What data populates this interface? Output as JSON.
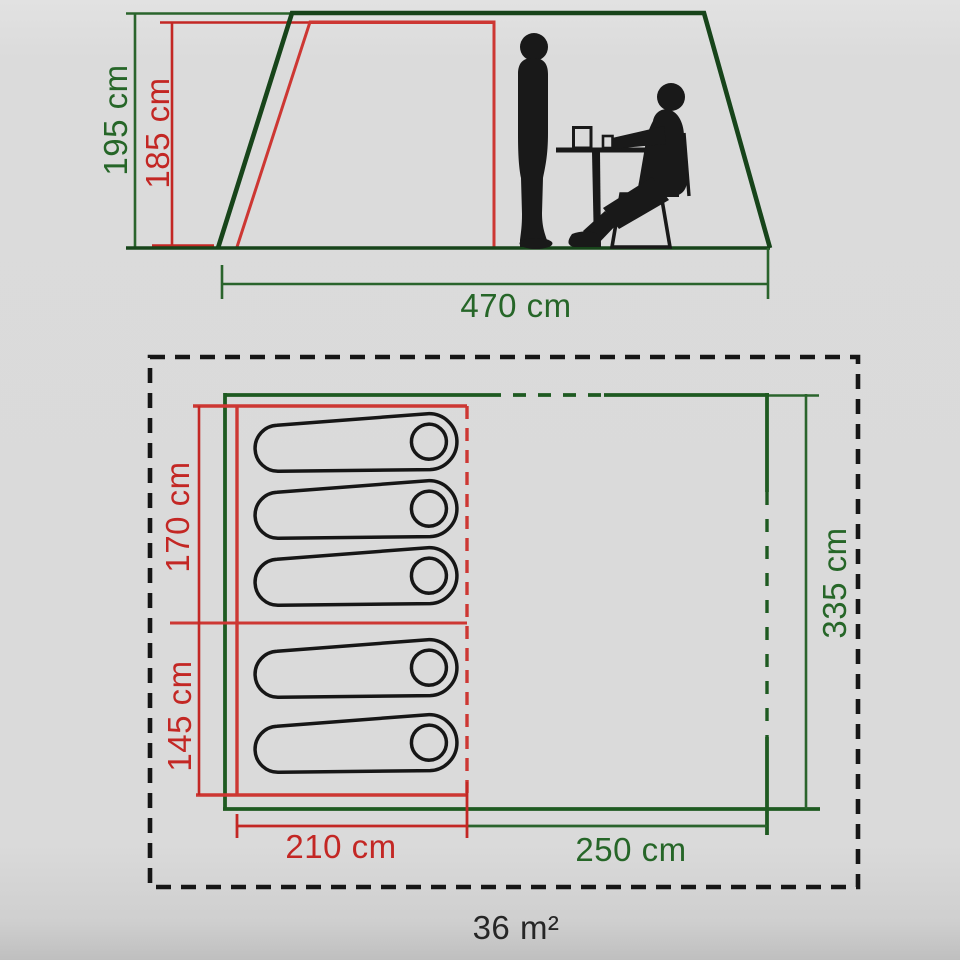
{
  "colors": {
    "tent_outline_green": "#17441a",
    "plan_line_green": "#1e5a21",
    "dimension_green_text": "#266628",
    "dimension_red": "#c32724",
    "plan_line_red": "#cd3733",
    "ink_black": "#1a1a1a",
    "background_gray": "#dadada"
  },
  "side_view": {
    "outer_height_label": "195 cm",
    "inner_height_label": "185 cm",
    "base_width_label": "470 cm",
    "figures": [
      "standing-person",
      "seated-person-at-table"
    ]
  },
  "floor_plan": {
    "bed_section_a_label": "170 cm",
    "bed_section_b_label": "145 cm",
    "inner_length_label": "335 cm",
    "bed_width_label": "210 cm",
    "living_width_label": "250 cm",
    "total_area_label": "36 m²",
    "sleeping_bag_count": 5
  }
}
